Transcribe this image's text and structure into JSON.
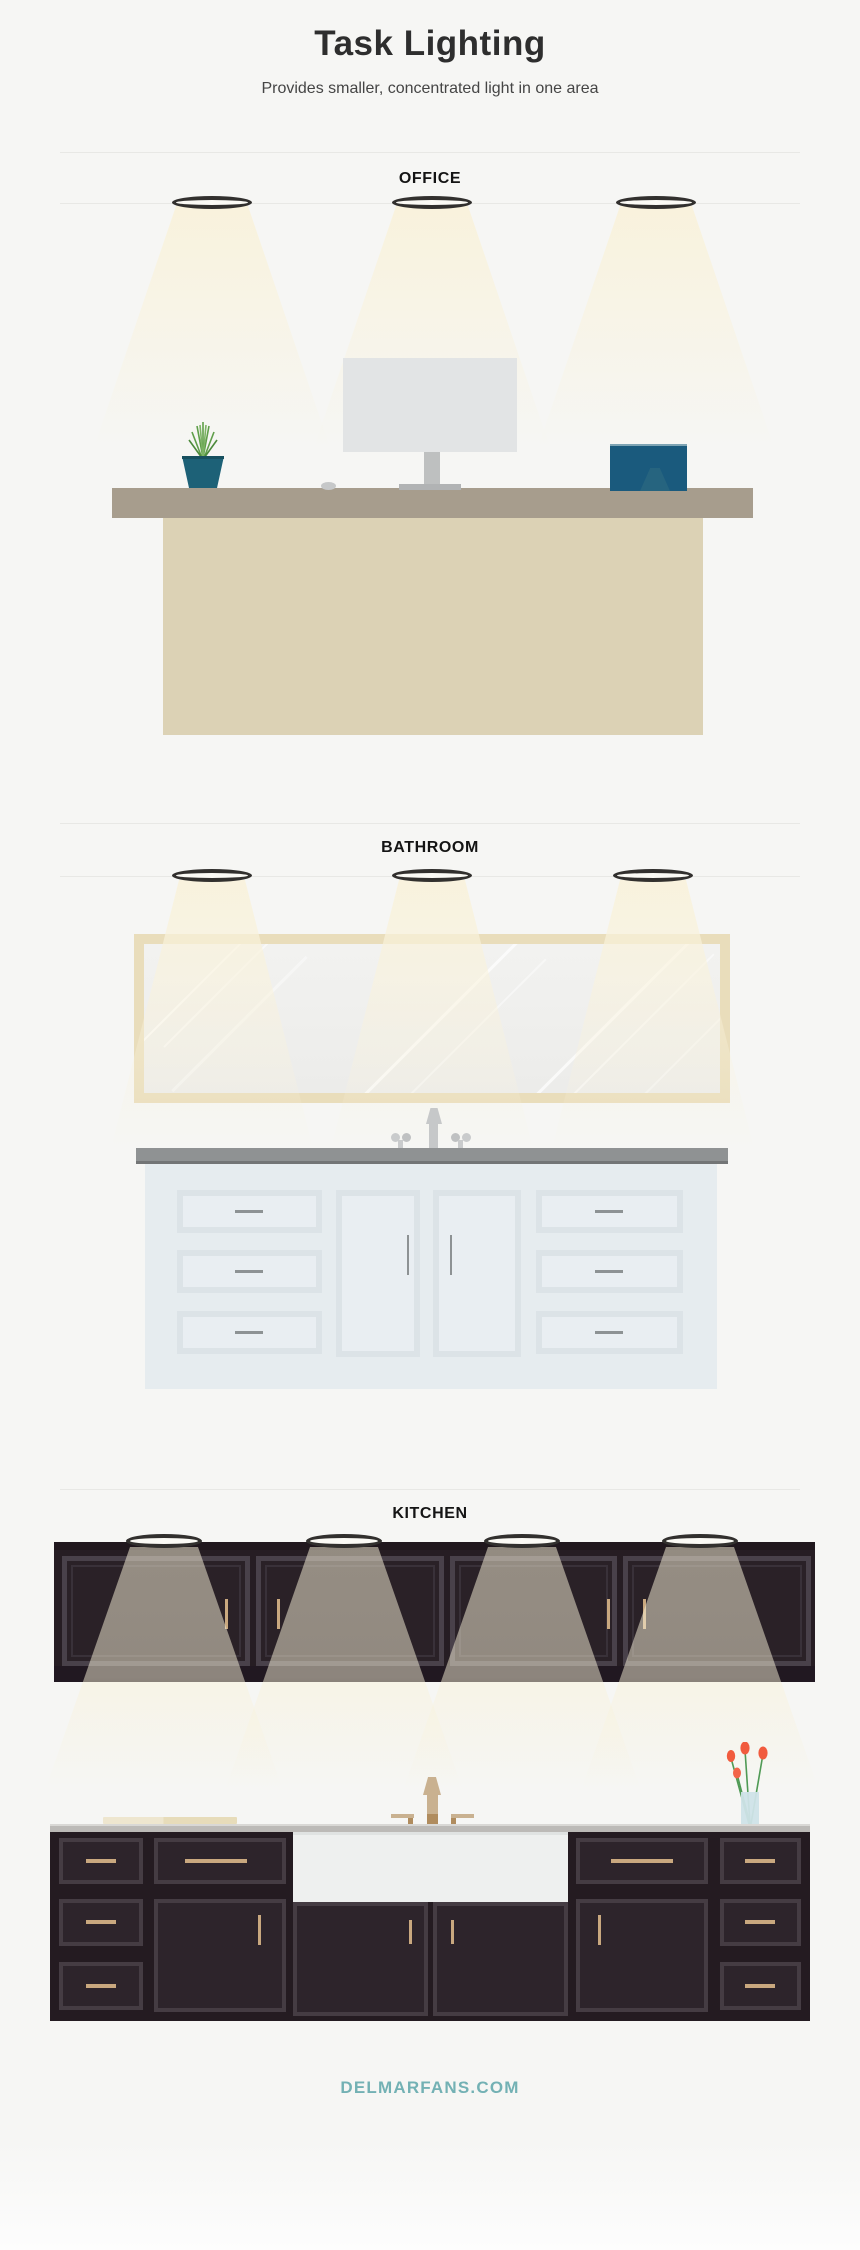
{
  "header": {
    "title": "Task Lighting",
    "subtitle": "Provides smaller, concentrated light in one area"
  },
  "sections": [
    {
      "label": "OFFICE",
      "lights": 3
    },
    {
      "label": "BATHROOM",
      "lights": 3
    },
    {
      "label": "KITCHEN",
      "lights": 4
    }
  ],
  "footer": {
    "brand": "DELMARFANS.COM"
  },
  "colors": {
    "background": "#f6f6f4",
    "beam_light": "#f8f1dc",
    "title_text": "#2e2e2e",
    "brand_teal": "#73b1b4",
    "divider": "#e8e8e5",
    "office_desk_top": "#a79d8d",
    "office_desk_body": "#dcd2b5",
    "office_monitor": "#e2e4e5",
    "office_plant_pot": "#1d6177",
    "office_book_blue": "#1a5a7d",
    "bathroom_counter": "#8f9293",
    "bathroom_vanity": "#e6ecef",
    "bathroom_mirror_frame": "#e9ddbb",
    "kitchen_cabinet_dark": "#261d23",
    "kitchen_handle_gold": "#c9a87f",
    "kitchen_faucet_gold": "#c9b190",
    "kitchen_flower_red": "#f15b3e"
  }
}
